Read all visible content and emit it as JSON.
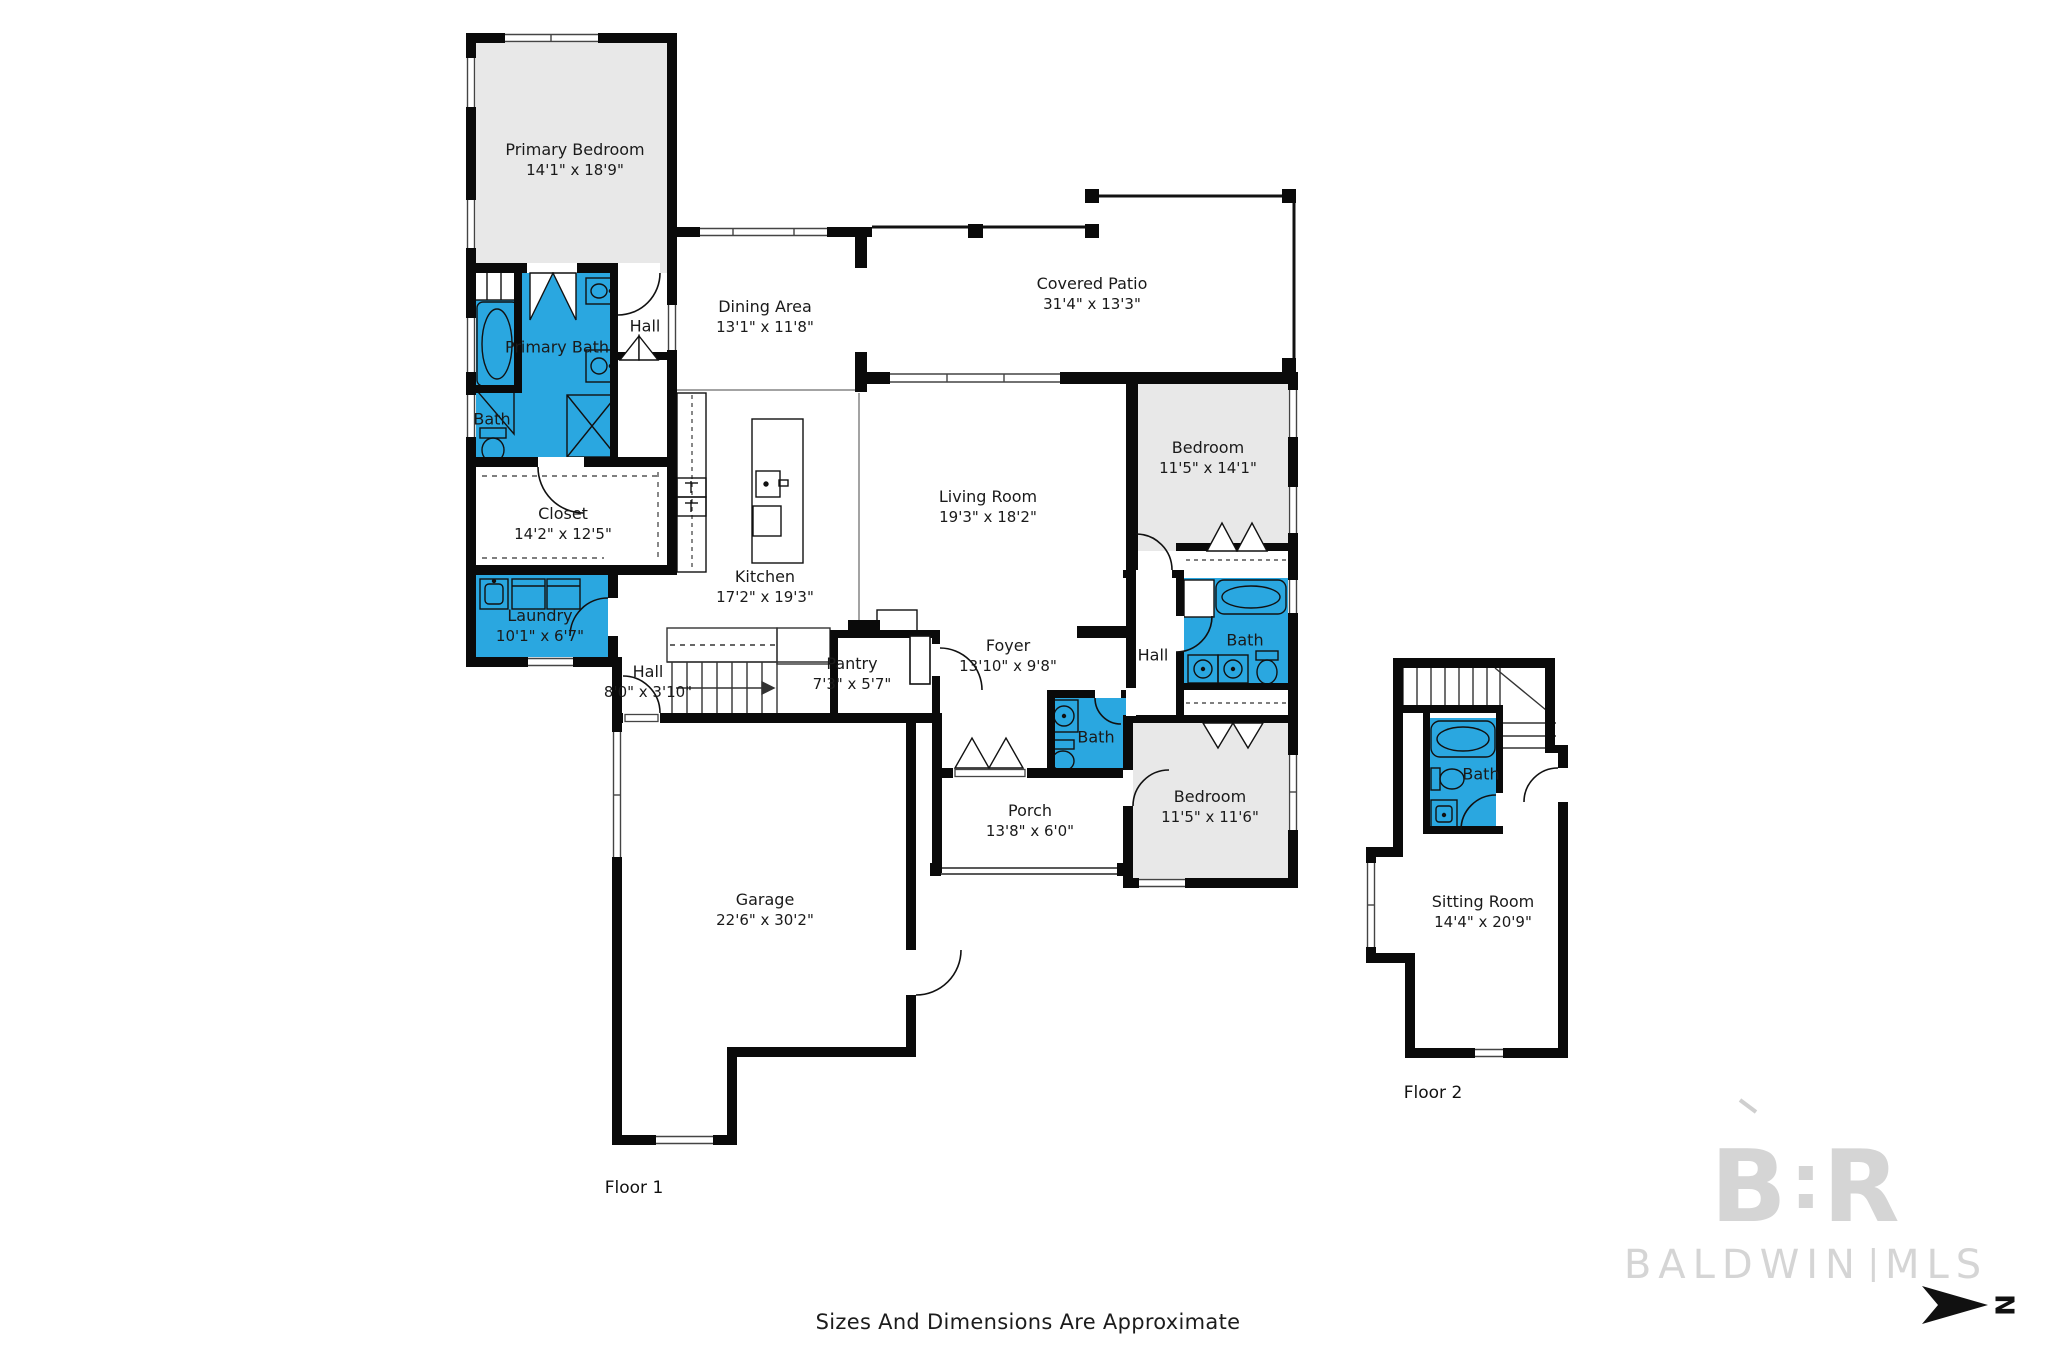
{
  "colors": {
    "bath_blue": "#2aa7e0",
    "room_gray": "#e8e8e8",
    "wall": "#0a0a0a",
    "watermark_gray": "#d5d5d5"
  },
  "rooms": {
    "primary_bedroom": {
      "name": "Primary Bedroom",
      "dims": "14'1\" x 18'9\""
    },
    "hall_primary": {
      "name": "Hall"
    },
    "primary_bath": {
      "name": "Primary Bath"
    },
    "bath_small": {
      "name": "Bath"
    },
    "closet": {
      "name": "Closet",
      "dims": "14'2\" x 12'5\""
    },
    "dining": {
      "name": "Dining Area",
      "dims": "13'1\" x 11'8\""
    },
    "patio": {
      "name": "Covered Patio",
      "dims": "31'4\" x 13'3\""
    },
    "living": {
      "name": "Living Room",
      "dims": "19'3\" x 18'2\""
    },
    "kitchen": {
      "name": "Kitchen",
      "dims": "17'2\" x 19'3\""
    },
    "bedroom_tr": {
      "name": "Bedroom",
      "dims": "11'5\" x 14'1\""
    },
    "bath_tr": {
      "name": "Bath"
    },
    "hall_right": {
      "name": "Hall"
    },
    "foyer": {
      "name": "Foyer",
      "dims": "13'10\" x 9'8\""
    },
    "pantry": {
      "name": "Pantry",
      "dims": "7'3\" x 5'7\""
    },
    "laundry": {
      "name": "Laundry",
      "dims": "10'1\" x 6'7\""
    },
    "hall_stairs": {
      "name": "Hall",
      "dims": "8'0\" x 3'10\""
    },
    "bath_foyer": {
      "name": "Bath"
    },
    "porch": {
      "name": "Porch",
      "dims": "13'8\" x 6'0\""
    },
    "bedroom_br": {
      "name": "Bedroom",
      "dims": "11'5\" x 11'6\""
    },
    "garage": {
      "name": "Garage",
      "dims": "22'6\" x 30'2\""
    },
    "bath_f2": {
      "name": "Bath"
    },
    "sitting": {
      "name": "Sitting Room",
      "dims": "14'4\" x 20'9\""
    }
  },
  "floor_labels": {
    "floor1": "Floor 1",
    "floor2": "Floor 2"
  },
  "footer": "Sizes And Dimensions Are Approximate",
  "watermark": {
    "logo_left": "B",
    "logo_right": "R",
    "name_left": "BALDWIN",
    "name_right": "MLS"
  },
  "compass": {
    "label": "N"
  }
}
